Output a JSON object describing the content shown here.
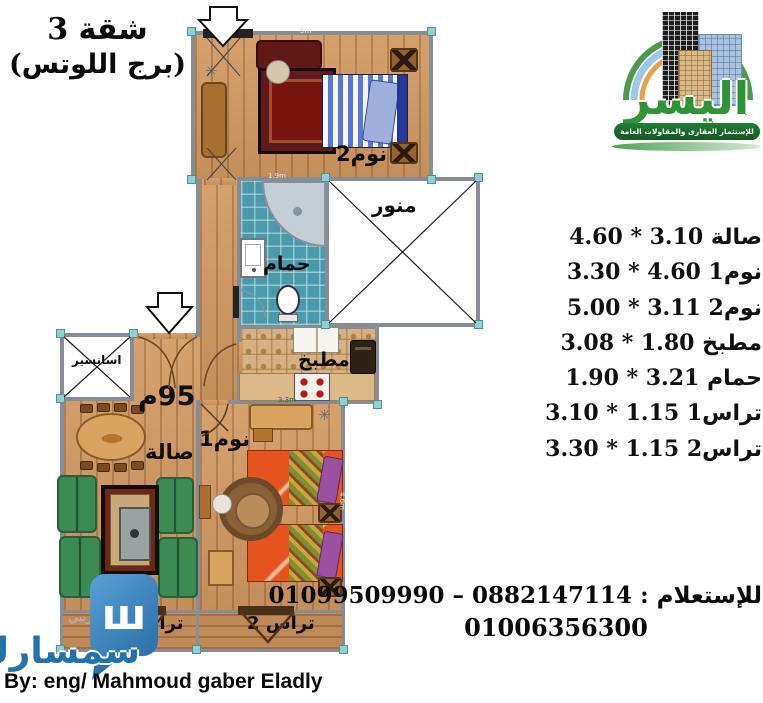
{
  "title": {
    "apartment": "شقة 3",
    "building": "(برج اللوتس)"
  },
  "logo": {
    "brand": "اليسر",
    "tagline": "للإستثمار العقارى والمقاولات العامة"
  },
  "plan": {
    "area_label": "95م",
    "rooms": {
      "bedroom2": "نوم2",
      "bathroom": "حمام",
      "lightwell": "منور",
      "kitchen": "مطبخ",
      "hall": "صالة",
      "bedroom1": "نوم1",
      "elevator": "اسانسير",
      "terrace1": "تراس1",
      "terrace2": "تراس 2"
    },
    "wall_dims": {
      "top": "5m",
      "bath_top": "1.9m",
      "kitchen_bottom": "3.3m",
      "bedroom1_right": "4.6m"
    },
    "icons": {
      "plant": "✳"
    }
  },
  "dimensions_list": [
    {
      "text": "صالة 3.10 * 4.60"
    },
    {
      "text": "نوم1 4.60 * 3.30"
    },
    {
      "text": "نوم2 3.11 * 5.00"
    },
    {
      "text": "مطبخ 1.80 * 3.08"
    },
    {
      "text": "حمام 3.21 * 1.90"
    },
    {
      "text": "تراس1 1.15 * 3.10"
    },
    {
      "text": "تراس2 1.15 * 3.30"
    }
  ],
  "contact": {
    "line1": "للإستعلام : 0882147114 – 01099509990",
    "line2": "01006356300"
  },
  "credit": "By: eng/ Mahmoud gaber Eladly",
  "watermark": {
    "trial": "تجريبي",
    "brand": "سمسارك",
    "icon_char": "ш"
  }
}
